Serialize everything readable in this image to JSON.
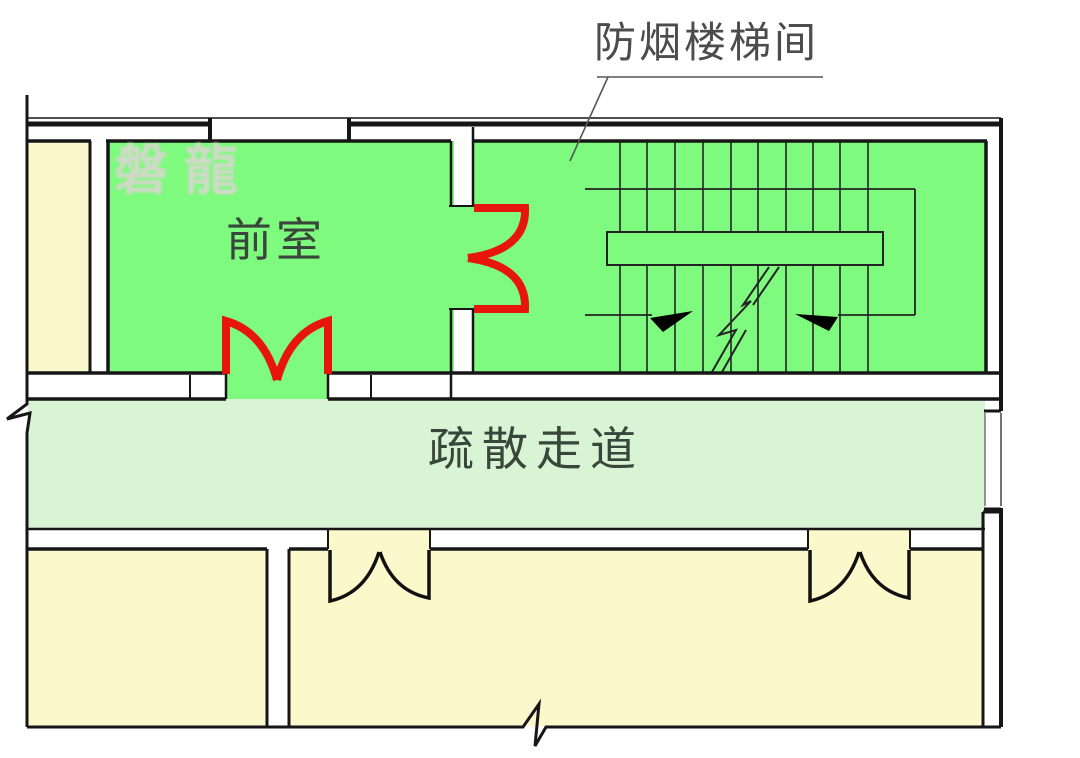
{
  "diagram": {
    "callout": {
      "text": "防烟楼梯间"
    },
    "rooms": {
      "vestibule": {
        "label": "前室"
      },
      "corridor": {
        "label": "疏散走道"
      }
    },
    "watermark": {
      "text": "磐龍"
    }
  },
  "colors": {
    "room-green": "#7efa7e",
    "corridor-green": "#d9f3d5",
    "room-cream": "#fbf8cc",
    "door-red": "#e8150d",
    "wall": "#161616",
    "stair-line": "#232323",
    "label-dark": "#39463b",
    "callout-gray": "#4c4c4c",
    "watermark-pink": "#e3d3d8"
  }
}
